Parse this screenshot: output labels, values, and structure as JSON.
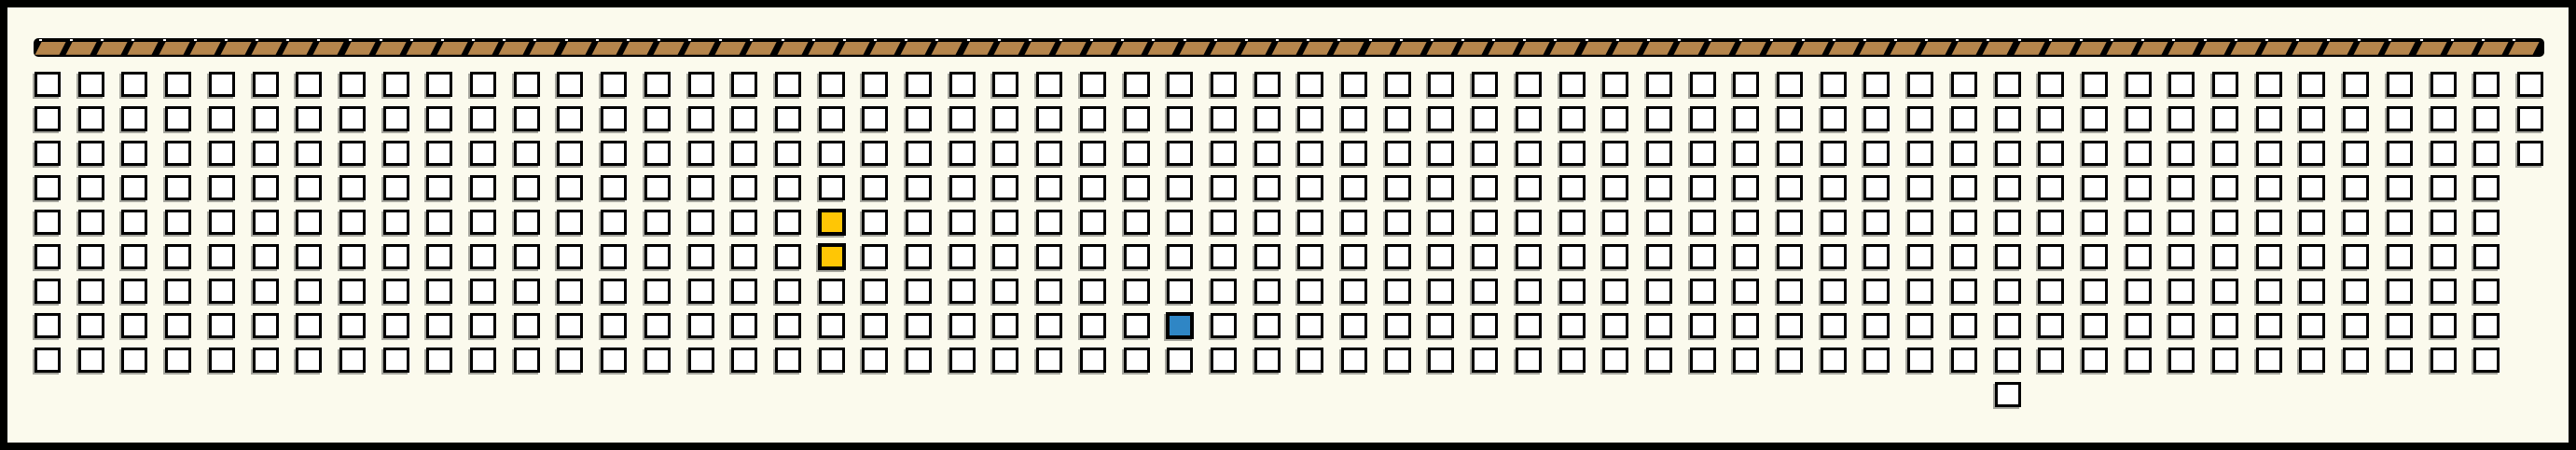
{
  "colors": {
    "background": "#FBFAED",
    "frame_border": "#000000",
    "stage_bar": "#000000",
    "plank_brown": "#B5854C",
    "plank_gap_dot": "#FFFFFF",
    "seat_fill": "#FFFFFF",
    "seat_border": "#000000",
    "seat_shadow": "#A6A69E",
    "seat_selected_yellow": "#FFC605",
    "seat_occupied_blue": "#2F86C5"
  },
  "stage": {
    "plank_count": 81
  },
  "grid": {
    "columns": 58,
    "rows": 9,
    "full_columns": 57,
    "last_column_rows": 3,
    "total_squares": 517,
    "yellow_squares": [
      {
        "col": 18,
        "row": 4
      },
      {
        "col": 18,
        "row": 5
      }
    ],
    "blue_square": {
      "col": 26,
      "row": 7
    },
    "detached_square": {
      "col": 45,
      "row": 9
    }
  }
}
